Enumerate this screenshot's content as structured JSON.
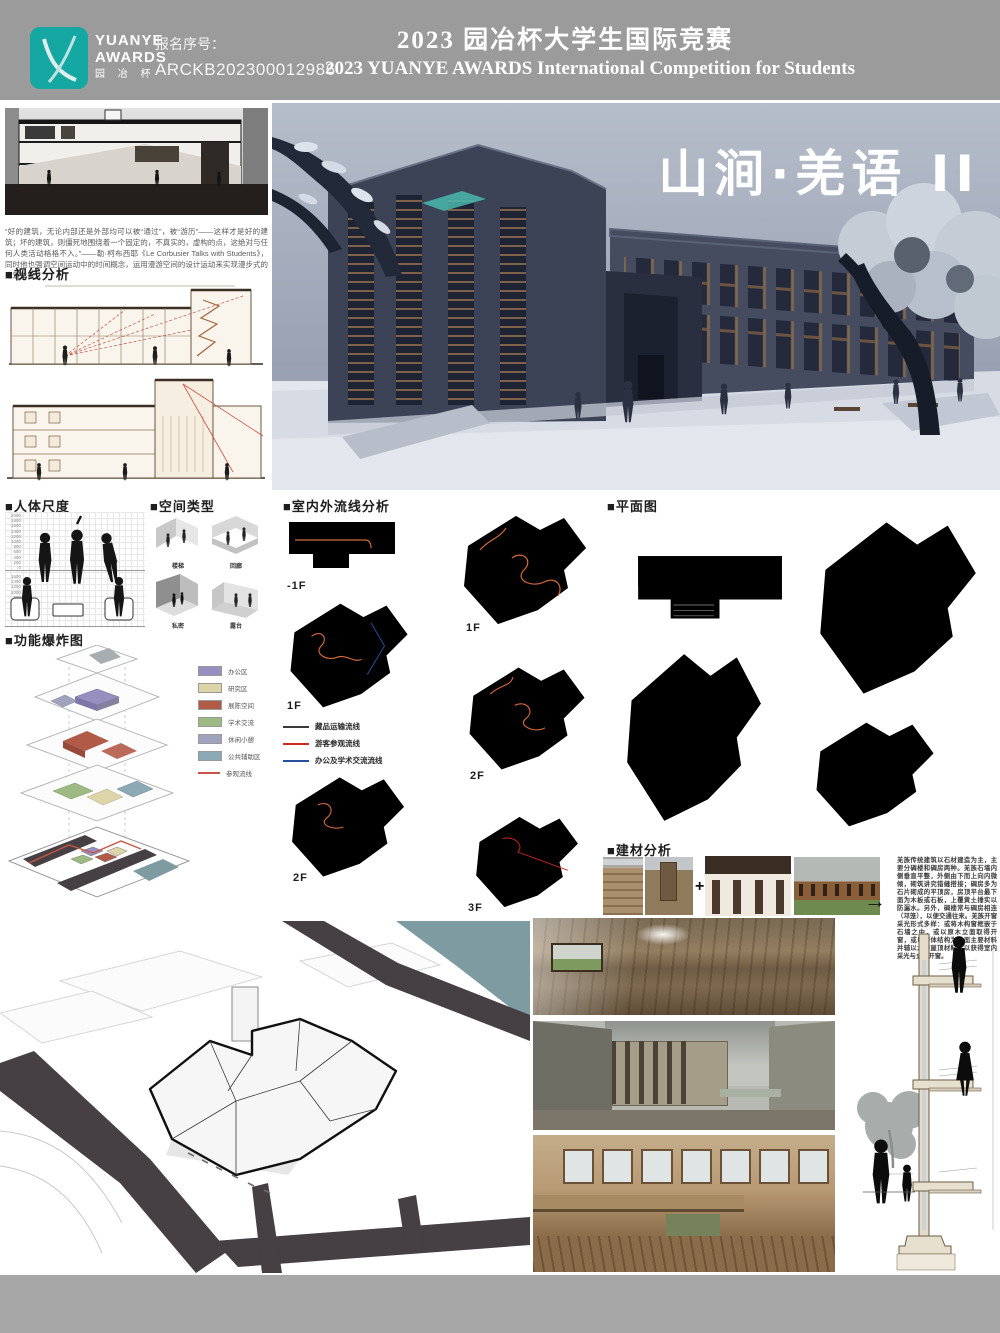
{
  "header": {
    "logo": {
      "line1": "YUANYE",
      "line2": "AWARDS",
      "line3": "园 冶 杯"
    },
    "registration_label": "报名序号：",
    "registration_number": "ARCKB202300012986",
    "title_cn": "2023 园冶杯大学生国际竞赛",
    "title_en": "2023 YUANYE AWARDS International Competition for  Students"
  },
  "hero": {
    "project_title": "山涧·羌语 II"
  },
  "intro": {
    "quote": "“好的建筑，无论内部还是外部均可以被“通过”，被“游历”——这样才是好的建筑；坏的建筑，则僵死地围绕着一个固定的，不真实的，虚构的点，这绝对与任何人类活动格格不入。”——勒·柯布西耶《Le Corbusier Talks with Students》，同时他也强调空间运动中的时间概念，运用漫游空间的设计运动来实现漫步式的建筑体验。"
  },
  "sections": {
    "sightline": "■视线分析",
    "human_scale": "■人体尺度",
    "space_type": "■空间类型",
    "explode": "■功能爆炸图",
    "circulation": "■室内外流线分析",
    "plans": "■平面图",
    "materials": "■建材分析"
  },
  "human_scale": {
    "ticks_top": [
      "2000",
      "1800",
      "1600",
      "1400",
      "1200",
      "1000",
      "800",
      "600",
      "400",
      "200",
      "0"
    ],
    "ticks_bottom": [
      "1600",
      "1400",
      "1200",
      "1000",
      "800",
      "600",
      "400",
      "200",
      "0"
    ]
  },
  "space_types": {
    "items": [
      {
        "label": "楼梯"
      },
      {
        "label": "回廊"
      },
      {
        "label": "私密"
      },
      {
        "label": "露台"
      }
    ]
  },
  "explode": {
    "legend": [
      {
        "label": "办公区",
        "color": "#968fc0"
      },
      {
        "label": "研究区",
        "color": "#ded4a9"
      },
      {
        "label": "展陈空间",
        "color": "#b25a48"
      },
      {
        "label": "学术交流",
        "color": "#9cba82"
      },
      {
        "label": "休闲小憩",
        "color": "#a0a3bd"
      },
      {
        "label": "公共辅助区",
        "color": "#8ea9b6"
      },
      {
        "label": "参观流线",
        "color": "#c85545"
      }
    ]
  },
  "circulation": {
    "legend": [
      {
        "label": "藏品运输流线",
        "color": "#3a3a3a"
      },
      {
        "label": "游客参观流线",
        "color": "#cc2b20"
      },
      {
        "label": "办公及学术交流流线",
        "color": "#2b4f9e"
      }
    ],
    "floors_left": [
      "-1F",
      "1F",
      "2F"
    ],
    "floors_right": [
      "1F",
      "2F",
      "3F"
    ]
  },
  "materials": {
    "plus": "+",
    "arrow": "→",
    "text": "羌族传统建筑以石材建造为主，主要分碉楼和碉房两种。羌族石墙内侧垂直平整，外侧由下而上向内微倾，砌筑讲究错缝搭接；碉房多为石片砌成的平顶房，房顶平台最下面为木板或石板，上覆黄土捶实以防漏水。另外，碉楼常与碉房相连（邛笼），以便交通往来。羌族开窗采光形式多样：或将木构窗框嵌于石墙之中，或以原木立面取得开窗，或以砌体结构为立面主要材料并辅以木构屋顶材料，以获得室内采光与立面开窗。"
  }
}
